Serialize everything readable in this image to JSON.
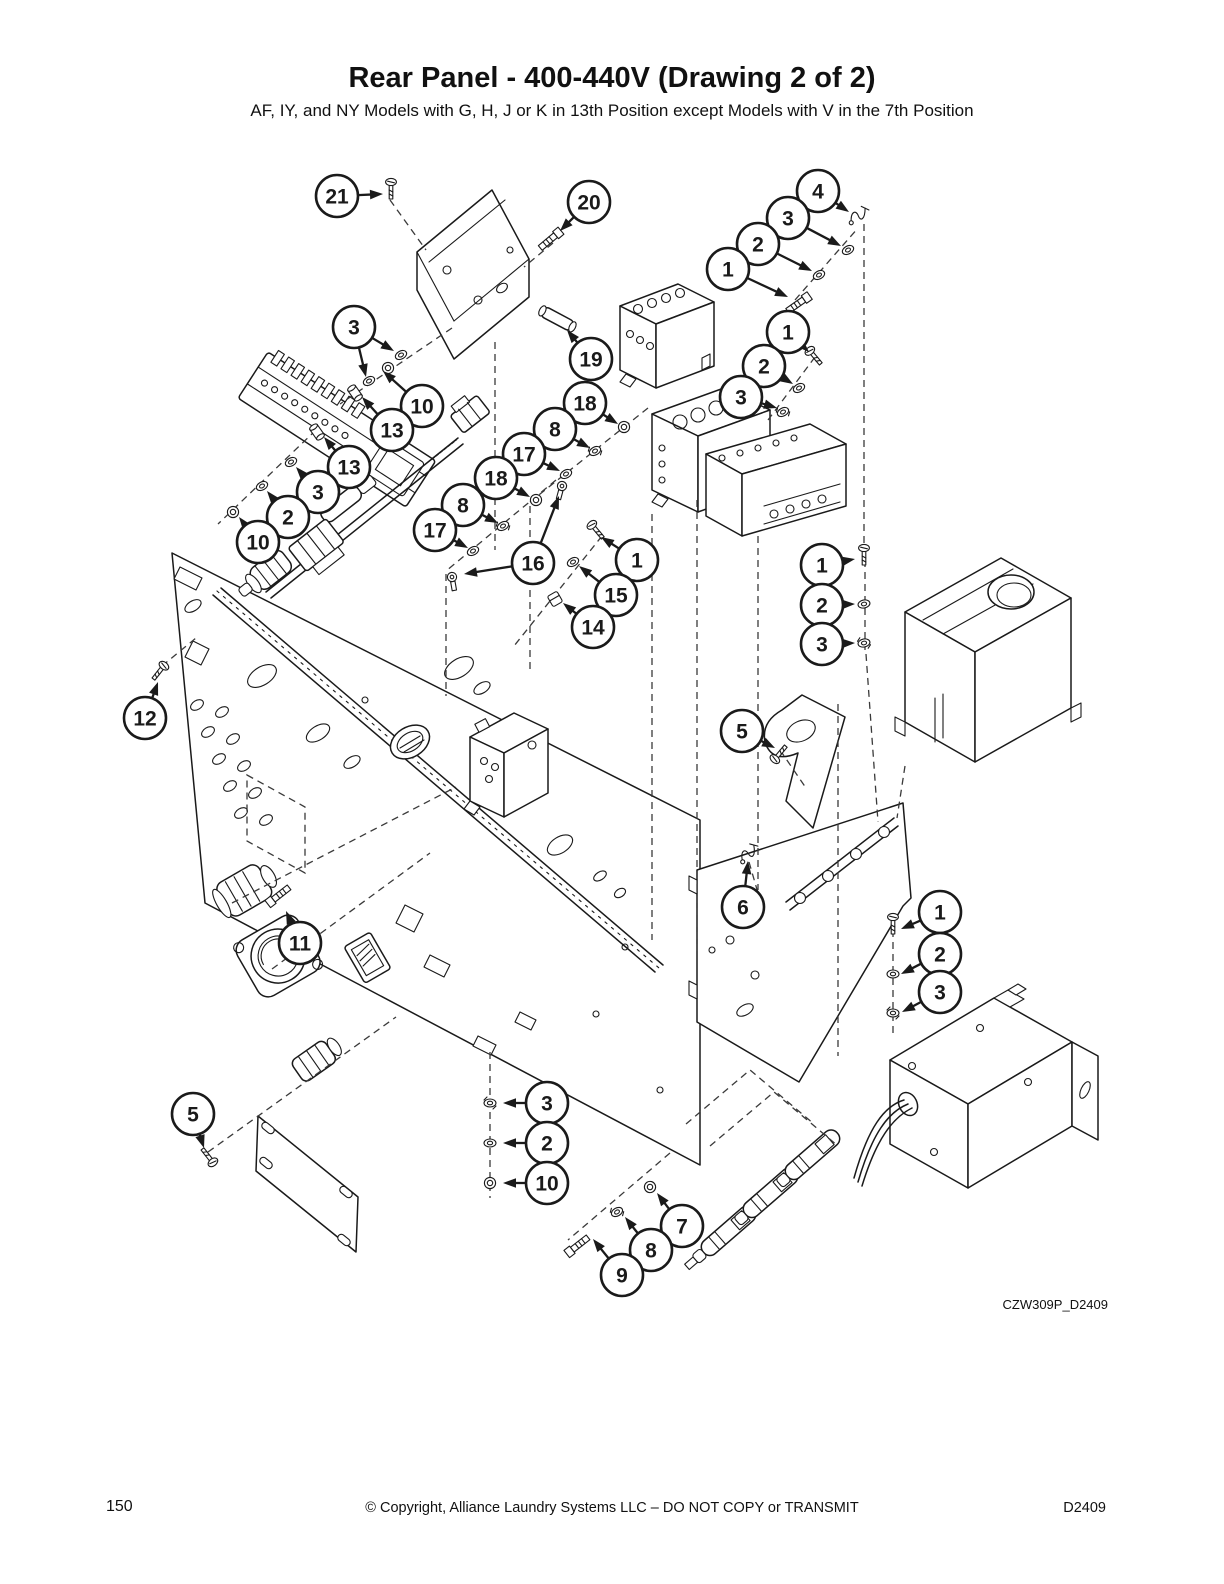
{
  "page": {
    "title": "Rear Panel - 400-440V (Drawing 2 of 2)",
    "subtitle": "AF, IY, and NY Models with G, H, J or K in 13th Position except Models with V in the 7th Position",
    "drawing_code": "CZW309P_D2409",
    "footer": {
      "page_number": "150",
      "copyright": "© Copyright, Alliance Laundry Systems LLC – DO NOT COPY or TRANSMIT",
      "doc_number": "D2409"
    }
  },
  "diagram": {
    "ink_color": "#1a1a1a",
    "leader_color": "#3a3a3a",
    "callout_radius": 21,
    "callouts": [
      {
        "n": "21",
        "x": 337,
        "y": 196,
        "t": [
          [
            383,
            194
          ]
        ]
      },
      {
        "n": "20",
        "x": 589,
        "y": 202,
        "t": [
          [
            560,
            231
          ]
        ]
      },
      {
        "n": "4",
        "x": 818,
        "y": 191,
        "t": [
          [
            849,
            212
          ]
        ]
      },
      {
        "n": "3",
        "x": 788,
        "y": 218,
        "t": [
          [
            841,
            246
          ]
        ]
      },
      {
        "n": "2",
        "x": 758,
        "y": 244,
        "t": [
          [
            812,
            271
          ]
        ]
      },
      {
        "n": "1",
        "x": 728,
        "y": 269,
        "t": [
          [
            788,
            297
          ]
        ]
      },
      {
        "n": "1",
        "x": 788,
        "y": 332,
        "t": [
          [
            809,
            352
          ]
        ]
      },
      {
        "n": "2",
        "x": 764,
        "y": 366,
        "t": [
          [
            793,
            384
          ]
        ]
      },
      {
        "n": "3",
        "x": 741,
        "y": 397,
        "t": [
          [
            777,
            408
          ]
        ]
      },
      {
        "n": "3",
        "x": 354,
        "y": 327,
        "t": [
          [
            394,
            351
          ],
          [
            366,
            377
          ]
        ]
      },
      {
        "n": "10",
        "x": 422,
        "y": 406,
        "t": [
          [
            383,
            371
          ]
        ]
      },
      {
        "n": "13",
        "x": 392,
        "y": 430,
        "t": [
          [
            362,
            397
          ]
        ]
      },
      {
        "n": "13",
        "x": 349,
        "y": 467,
        "t": [
          [
            324,
            437
          ]
        ]
      },
      {
        "n": "3",
        "x": 318,
        "y": 492,
        "t": [
          [
            296,
            467
          ]
        ]
      },
      {
        "n": "2",
        "x": 288,
        "y": 517,
        "t": [
          [
            267,
            491
          ]
        ]
      },
      {
        "n": "10",
        "x": 258,
        "y": 542,
        "t": [
          [
            239,
            517
          ]
        ]
      },
      {
        "n": "19",
        "x": 591,
        "y": 359,
        "t": [
          [
            567,
            330
          ]
        ]
      },
      {
        "n": "18",
        "x": 585,
        "y": 403,
        "t": [
          [
            618,
            424
          ]
        ]
      },
      {
        "n": "8",
        "x": 555,
        "y": 429,
        "t": [
          [
            590,
            448
          ]
        ]
      },
      {
        "n": "17",
        "x": 524,
        "y": 454,
        "t": [
          [
            560,
            471
          ]
        ]
      },
      {
        "n": "18",
        "x": 496,
        "y": 478,
        "t": [
          [
            530,
            497
          ]
        ]
      },
      {
        "n": "8",
        "x": 463,
        "y": 505,
        "t": [
          [
            498,
            523
          ]
        ]
      },
      {
        "n": "17",
        "x": 435,
        "y": 530,
        "t": [
          [
            468,
            548
          ]
        ]
      },
      {
        "n": "16",
        "x": 533,
        "y": 563,
        "t": [
          [
            559,
            496
          ],
          [
            464,
            574
          ]
        ]
      },
      {
        "n": "1",
        "x": 637,
        "y": 560,
        "t": [
          [
            601,
            537
          ]
        ]
      },
      {
        "n": "15",
        "x": 616,
        "y": 595,
        "t": [
          [
            579,
            566
          ]
        ]
      },
      {
        "n": "14",
        "x": 593,
        "y": 627,
        "t": [
          [
            563,
            603
          ]
        ]
      },
      {
        "n": "1",
        "x": 822,
        "y": 565,
        "t": [
          [
            855,
            559
          ]
        ]
      },
      {
        "n": "2",
        "x": 822,
        "y": 605,
        "t": [
          [
            855,
            604
          ]
        ]
      },
      {
        "n": "3",
        "x": 822,
        "y": 644,
        "t": [
          [
            855,
            643
          ]
        ]
      },
      {
        "n": "12",
        "x": 145,
        "y": 718,
        "t": [
          [
            158,
            682
          ]
        ]
      },
      {
        "n": "5",
        "x": 742,
        "y": 731,
        "t": [
          [
            775,
            748
          ]
        ]
      },
      {
        "n": "6",
        "x": 743,
        "y": 907,
        "t": [
          [
            748,
            861
          ]
        ]
      },
      {
        "n": "11",
        "x": 300,
        "y": 943,
        "t": [
          [
            286,
            911
          ]
        ]
      },
      {
        "n": "1",
        "x": 940,
        "y": 912,
        "t": [
          [
            901,
            929
          ]
        ]
      },
      {
        "n": "2",
        "x": 940,
        "y": 954,
        "t": [
          [
            901,
            974
          ]
        ]
      },
      {
        "n": "3",
        "x": 940,
        "y": 992,
        "t": [
          [
            902,
            1012
          ]
        ]
      },
      {
        "n": "5",
        "x": 193,
        "y": 1114,
        "t": [
          [
            204,
            1148
          ]
        ]
      },
      {
        "n": "3",
        "x": 547,
        "y": 1103,
        "t": [
          [
            503,
            1103
          ]
        ]
      },
      {
        "n": "2",
        "x": 547,
        "y": 1143,
        "t": [
          [
            503,
            1143
          ]
        ]
      },
      {
        "n": "10",
        "x": 547,
        "y": 1183,
        "t": [
          [
            503,
            1183
          ]
        ]
      },
      {
        "n": "7",
        "x": 682,
        "y": 1226,
        "t": [
          [
            657,
            1193
          ]
        ]
      },
      {
        "n": "8",
        "x": 651,
        "y": 1250,
        "t": [
          [
            625,
            1217
          ]
        ]
      },
      {
        "n": "9",
        "x": 622,
        "y": 1275,
        "t": [
          [
            593,
            1239
          ]
        ]
      }
    ],
    "fasteners": [
      {
        "t": "screw",
        "x": 391,
        "y": 190,
        "r": 0
      },
      {
        "t": "bolt",
        "x": 551,
        "y": 239,
        "r": 140
      },
      {
        "t": "clamp",
        "x": 858,
        "y": 215,
        "r": -20
      },
      {
        "t": "washer",
        "x": 848,
        "y": 250,
        "r": -28
      },
      {
        "t": "washer",
        "x": 819,
        "y": 275,
        "r": -28
      },
      {
        "t": "bolt",
        "x": 799,
        "y": 303,
        "r": 145
      },
      {
        "t": "screw",
        "x": 815,
        "y": 357,
        "r": -40
      },
      {
        "t": "washer",
        "x": 799,
        "y": 388,
        "r": -28
      },
      {
        "t": "lock",
        "x": 783,
        "y": 412,
        "r": -28
      },
      {
        "t": "washer",
        "x": 401,
        "y": 355,
        "r": -28
      },
      {
        "t": "nut",
        "x": 388,
        "y": 368,
        "r": 0
      },
      {
        "t": "washer",
        "x": 369,
        "y": 381,
        "r": -28
      },
      {
        "t": "spacer",
        "x": 355,
        "y": 393,
        "r": -35
      },
      {
        "t": "spacer",
        "x": 317,
        "y": 432,
        "r": -35
      },
      {
        "t": "washer",
        "x": 291,
        "y": 462,
        "r": -28
      },
      {
        "t": "washer",
        "x": 262,
        "y": 486,
        "r": -28
      },
      {
        "t": "nut",
        "x": 233,
        "y": 512,
        "r": 0
      },
      {
        "t": "nut",
        "x": 624,
        "y": 427,
        "r": 0
      },
      {
        "t": "lock",
        "x": 595,
        "y": 451,
        "r": -28
      },
      {
        "t": "washer",
        "x": 566,
        "y": 474,
        "r": -28
      },
      {
        "t": "nut",
        "x": 536,
        "y": 500,
        "r": 0
      },
      {
        "t": "lock",
        "x": 503,
        "y": 526,
        "r": -28
      },
      {
        "t": "washer",
        "x": 473,
        "y": 551,
        "r": -28
      },
      {
        "t": "term",
        "x": 562,
        "y": 486,
        "r": 15
      },
      {
        "t": "term",
        "x": 452,
        "y": 577,
        "r": -10
      },
      {
        "t": "screw",
        "x": 597,
        "y": 531,
        "r": -40
      },
      {
        "t": "washer",
        "x": 573,
        "y": 562,
        "r": -28
      },
      {
        "t": "clip",
        "x": 555,
        "y": 599,
        "r": -30
      },
      {
        "t": "screw",
        "x": 864,
        "y": 556,
        "r": 0
      },
      {
        "t": "washer",
        "x": 864,
        "y": 604,
        "r": -12
      },
      {
        "t": "lock",
        "x": 864,
        "y": 643,
        "r": -12
      },
      {
        "t": "screw",
        "x": 159,
        "y": 672,
        "r": 38
      },
      {
        "t": "screw",
        "x": 780,
        "y": 753,
        "r": -140
      },
      {
        "t": "clamp",
        "x": 748,
        "y": 853,
        "r": -30
      },
      {
        "t": "bolt",
        "x": 278,
        "y": 896,
        "r": -38
      },
      {
        "t": "screw",
        "x": 893,
        "y": 925,
        "r": 0
      },
      {
        "t": "washer",
        "x": 893,
        "y": 974,
        "r": 0
      },
      {
        "t": "lock",
        "x": 893,
        "y": 1013,
        "r": 0
      },
      {
        "t": "screw",
        "x": 208,
        "y": 1156,
        "r": 142
      },
      {
        "t": "lock",
        "x": 490,
        "y": 1103,
        "r": 0
      },
      {
        "t": "washer",
        "x": 490,
        "y": 1143,
        "r": 0
      },
      {
        "t": "nut",
        "x": 490,
        "y": 1183,
        "r": 0
      },
      {
        "t": "nut",
        "x": 650,
        "y": 1187,
        "r": -30
      },
      {
        "t": "lock",
        "x": 617,
        "y": 1212,
        "r": -30
      },
      {
        "t": "bolt",
        "x": 577,
        "y": 1246,
        "r": -38
      }
    ],
    "leaders": [
      "390,200 426,250",
      "553,243 524,267",
      "452,328 340,404",
      "316,430 218,524",
      "795,300 858,228",
      "864,224 864,548",
      "815,357 768,420",
      "495,342 495,550",
      "648,408 530,502",
      "556,480 446,571",
      "446,574 446,696",
      "530,506 530,672",
      "602,536 514,646",
      "652,514 652,940",
      "697,500 697,953",
      "758,536 758,890",
      "838,704 838,1056",
      "905,766 897,818",
      "865,560 865,650",
      "866,654 878,822",
      "162,666 196,638",
      "780,750 806,788",
      "232,903 456,787",
      "272,969 430,853",
      "208,1152 396,1017",
      "490,1052 490,1198",
      "670,1153 568,1240",
      "893,918 893,1036",
      "749,862 758,893",
      "686,1124 750,1070 814,1124",
      "710,1146 774,1092 838,1146"
    ]
  }
}
